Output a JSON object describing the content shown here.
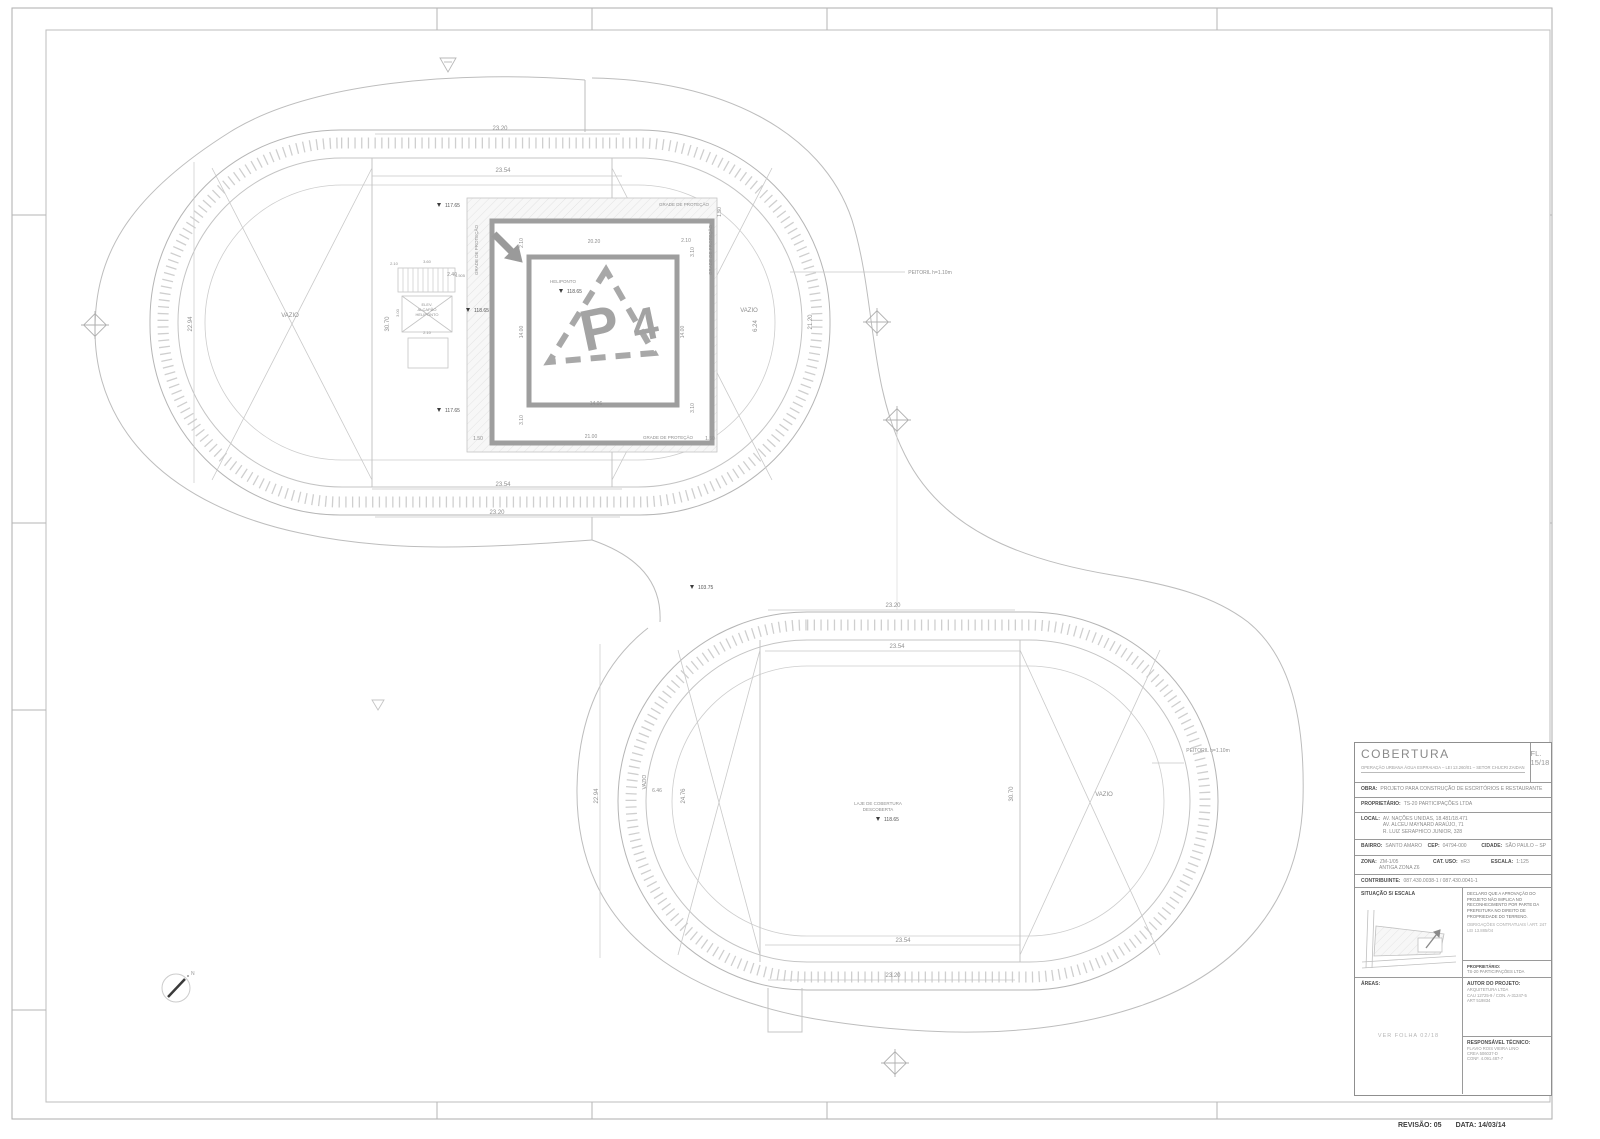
{
  "sheet": {
    "revision": "REVISÃO: 05",
    "date": "DATA: 14/03/14"
  },
  "title_block": {
    "title": "COBERTURA",
    "subtitle": "OPERAÇÃO URBANA ÁGUA ESPRAIADA – LEI 13.260/01 – SETOR CHUCRI ZAIDAN",
    "sheet_number": "FL. 15/18",
    "obra_label": "OBRA:",
    "obra": "PROJETO PARA CONSTRUÇÃO DE ESCRITÓRIOS E RESTAURANTE",
    "proprietario_label": "PROPRIETÁRIO:",
    "proprietario": "TS-20 PARTICIPAÇÕES LTDA",
    "local_label": "LOCAL:",
    "local_lines": [
      "AV. NAÇÕES UNIDAS, 18.481/18.471",
      "AV. ALCEU MAYNARD ARAÚJO, 71",
      "R. LUIZ SERAPHICO JUNIOR, 328"
    ],
    "bairro_label": "BAIRRO:",
    "bairro": "SANTO AMARO",
    "cep_label": "CEP:",
    "cep": "04794-000",
    "cidade_label": "CIDADE:",
    "cidade": "SÃO PAULO – SP",
    "zona_label": "ZONA:",
    "zona": "ZM-1/05",
    "zona2": "ANTIGA ZONA Z6",
    "cat_uso_label": "CAT. USO:",
    "cat_uso": "nR3",
    "escala_label": "ESCALA:",
    "escala": "1:125",
    "contribuinte_label": "CONTRIBUINTE:",
    "contribuinte": "087.430.0038-1 / 087.430.0041-1",
    "situacao_label": "SITUAÇÃO S/ ESCALA",
    "declaracao": "DECLARO QUE A APROVAÇÃO DO PROJETO NÃO IMPLICA NO RECONHECIMENTO POR PARTE DA PREFEITURA NO DIREITO DE PROPRIEDADE DO TERRENO.",
    "declaracao2": "OBRIGAÇÕES CONTRATUAIS \\ ART. 247 LEI 13.885/04",
    "assinatura_proprietario_label": "PROPRIETÁRIO:",
    "assinatura_proprietario": "TS-20 PARTICIPAÇÕES LTDA",
    "areas_label": "ÁREAS:",
    "areas_ref": "VER FOLHA 02/18",
    "autor_label": "AUTOR DO PROJETO:",
    "autor_lines": [
      "ARQUITETURA LTDA",
      "CAU 12725-9 / CON. A-31247-5",
      "ART 519834"
    ],
    "resp_label": "RESPONSÁVEL TÉCNICO:",
    "resp_lines": [
      "FLAVIO ROIS VIEIRA LINO",
      "CREA 506037-D",
      "CONF. 4.091.487-7"
    ]
  },
  "plan": {
    "labels": [
      {
        "t": "23.20",
        "x": 500,
        "y": 130
      },
      {
        "t": "23.54",
        "x": 503,
        "y": 172
      },
      {
        "t": "23.54",
        "x": 503,
        "y": 486
      },
      {
        "t": "23.20",
        "x": 497,
        "y": 514
      },
      {
        "t": "22.94",
        "x": 192,
        "y": 324,
        "r": -90
      },
      {
        "t": "30.70",
        "x": 389,
        "y": 324,
        "r": -90
      },
      {
        "t": "21.20",
        "x": 812,
        "y": 322,
        "r": -90
      },
      {
        "t": "6.24",
        "x": 757,
        "y": 326,
        "r": -90
      },
      {
        "t": "VAZIO",
        "x": 290,
        "y": 317
      },
      {
        "t": "VAZIO",
        "x": 749,
        "y": 312
      },
      {
        "t": "PEITORIL  h=1.10m",
        "x": 930,
        "y": 274,
        "s": 5
      },
      {
        "t": "GRADE DE PROTEÇÃO",
        "x": 684,
        "y": 206,
        "s": 4.5
      },
      {
        "t": "GRADE DE PROTEÇÃO",
        "x": 478,
        "y": 250,
        "r": -90,
        "s": 4.5
      },
      {
        "t": "GRADE DE PROTEÇÃO",
        "x": 712,
        "y": 250,
        "r": -90,
        "s": 4.5
      },
      {
        "t": "GRADE DE PROTEÇÃO",
        "x": 668,
        "y": 439,
        "s": 4.5
      },
      {
        "t": "20.20",
        "x": 594,
        "y": 243,
        "s": 5
      },
      {
        "t": "2.10",
        "x": 686,
        "y": 242,
        "s": 5
      },
      {
        "t": "2.10",
        "x": 523,
        "y": 243,
        "r": -90,
        "s": 5
      },
      {
        "t": "3.10",
        "x": 694,
        "y": 252,
        "r": -90,
        "s": 5
      },
      {
        "t": "14.00",
        "x": 523,
        "y": 332,
        "r": -90,
        "s": 5
      },
      {
        "t": "14.00",
        "x": 684,
        "y": 332,
        "r": -90,
        "s": 5
      },
      {
        "t": "3.10",
        "x": 694,
        "y": 408,
        "r": -90,
        "s": 5
      },
      {
        "t": "3.10",
        "x": 523,
        "y": 420,
        "r": -90,
        "s": 5
      },
      {
        "t": "14.06",
        "x": 596,
        "y": 405,
        "s": 5
      },
      {
        "t": "21.00",
        "x": 591,
        "y": 438,
        "s": 5
      },
      {
        "t": "1.50",
        "x": 478,
        "y": 440,
        "s": 5
      },
      {
        "t": "1.50",
        "x": 710,
        "y": 440,
        "s": 5
      },
      {
        "t": "1.50",
        "x": 721,
        "y": 212,
        "r": -90,
        "s": 5
      },
      {
        "t": "2.40",
        "x": 452,
        "y": 276,
        "s": 5
      },
      {
        "t": "HELIPONTO",
        "x": 563,
        "y": 283,
        "s": 4.5
      },
      {
        "t": "118.65",
        "x": 567,
        "y": 293,
        "m": 1,
        "s": 5
      },
      {
        "t": "118.65",
        "x": 474,
        "y": 312,
        "m": 1,
        "s": 5
      },
      {
        "t": "117.65",
        "x": 445,
        "y": 207,
        "m": 1,
        "s": 5
      },
      {
        "t": "117.65",
        "x": 445,
        "y": 412,
        "m": 1,
        "s": 5
      },
      {
        "t": "ELEV.",
        "x": 427,
        "y": 306,
        "s": 4
      },
      {
        "t": "ALÇAPÃO",
        "x": 427,
        "y": 311,
        "s": 4
      },
      {
        "t": "HELIPONTO",
        "x": 427,
        "y": 316,
        "s": 4
      },
      {
        "t": "2.10",
        "x": 394,
        "y": 265,
        "s": 4
      },
      {
        "t": "3.60",
        "x": 427,
        "y": 263,
        "s": 4
      },
      {
        "t": "1.505",
        "x": 460,
        "y": 277,
        "s": 4
      },
      {
        "t": "3.00",
        "x": 399,
        "y": 313,
        "r": -90,
        "s": 4
      },
      {
        "t": "2.10",
        "x": 427,
        "y": 334,
        "s": 4
      },
      {
        "t": "103.75",
        "x": 698,
        "y": 589,
        "m": 1,
        "s": 5
      },
      {
        "t": "23.20",
        "x": 893,
        "y": 607
      },
      {
        "t": "23.54",
        "x": 897,
        "y": 648
      },
      {
        "t": "23.54",
        "x": 903,
        "y": 942
      },
      {
        "t": "23.20",
        "x": 893,
        "y": 977
      },
      {
        "t": "22.94",
        "x": 598,
        "y": 796,
        "r": -90
      },
      {
        "t": "24.76",
        "x": 685,
        "y": 796,
        "r": -90
      },
      {
        "t": "6.46",
        "x": 657,
        "y": 792,
        "s": 5
      },
      {
        "t": "30.70",
        "x": 1013,
        "y": 794,
        "r": -90
      },
      {
        "t": "VAZIO",
        "x": 646,
        "y": 782,
        "r": -90,
        "s": 5
      },
      {
        "t": "VAZIO",
        "x": 1104,
        "y": 796
      },
      {
        "t": "PEITORIL  h=1.10m",
        "x": 1208,
        "y": 752,
        "s": 5
      },
      {
        "t": "LAJE DE COBERTURA",
        "x": 878,
        "y": 805,
        "s": 4.5
      },
      {
        "t": "DESCOBERTA",
        "x": 878,
        "y": 811,
        "s": 4.5
      },
      {
        "t": "118.65",
        "x": 884,
        "y": 821,
        "m": 1,
        "s": 5
      }
    ]
  },
  "colors": {
    "line": "#b5b5b5",
    "tick": "#cccccc",
    "heavy": "#9e9e9e",
    "text": "#8f8f8f",
    "level_text": "#555555"
  }
}
